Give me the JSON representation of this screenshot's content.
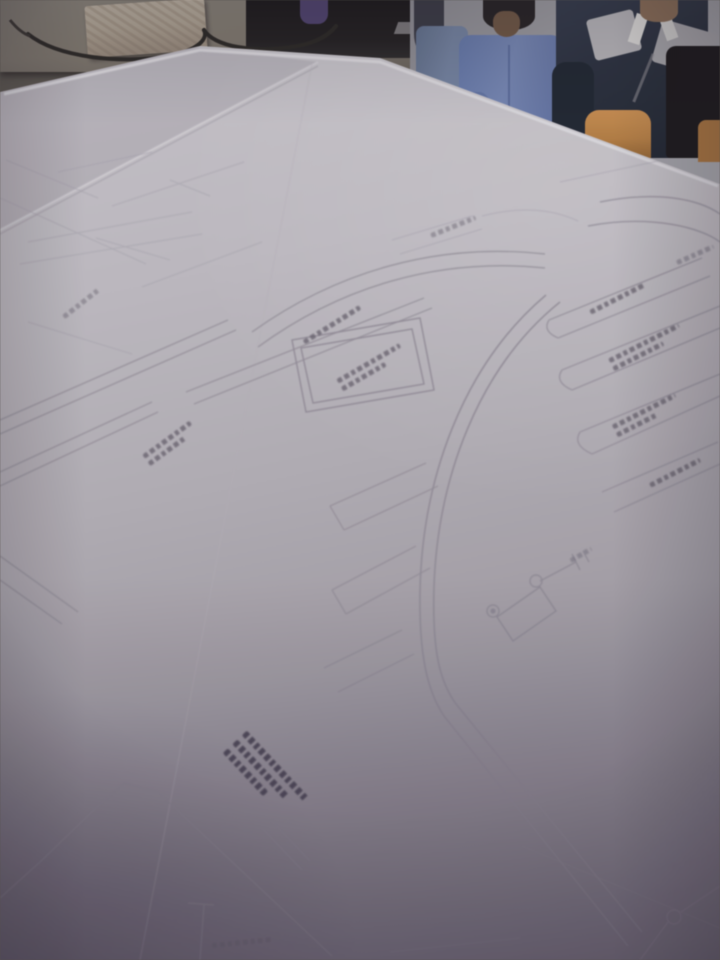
{
  "scene": {
    "label": "Photograph of a workshop cutting table covered with large sheets of garment pattern drafting paper",
    "people": [
      {
        "label": "worker in light blue shirt, partially visible at left of group"
      },
      {
        "label": "worker in blue short-sleeve shirt with head bowed"
      },
      {
        "label": "worker in dark polo shirt with light gray shoulder panels and white collar"
      }
    ],
    "objects": [
      {
        "label": "beige box and dark power cable on side table"
      },
      {
        "label": "dark workshop equipment behind side table"
      },
      {
        "label": "orange chair back behind table edge"
      },
      {
        "label": "white drafting paper with pencil-drawn garment pattern pieces, seam lines, drill-hole circles"
      },
      {
        "label": "handwritten pattern code annotations (illegible in photo)"
      }
    ]
  },
  "colors": {
    "paper-light": "#c7c4ca",
    "paper-mid": "#b1acb4",
    "paper-dark": "#7e7886",
    "pencil-line": "#918b97",
    "annotation-ink": "#5d5864",
    "wall": "#97969d",
    "shirt-blue": "#7284b4",
    "shirt-light-blue": "#7080a0",
    "polo-dark": "#2a303f",
    "vest-gray": "#b1afb4",
    "skin": "#8a6c55",
    "hair-dark": "#272225",
    "orange": "#b57b3e",
    "side-table": "#7e766d",
    "box-beige": "#ac9f90",
    "cable-dark": "#2c2826",
    "equipment-dark": "#232022"
  }
}
